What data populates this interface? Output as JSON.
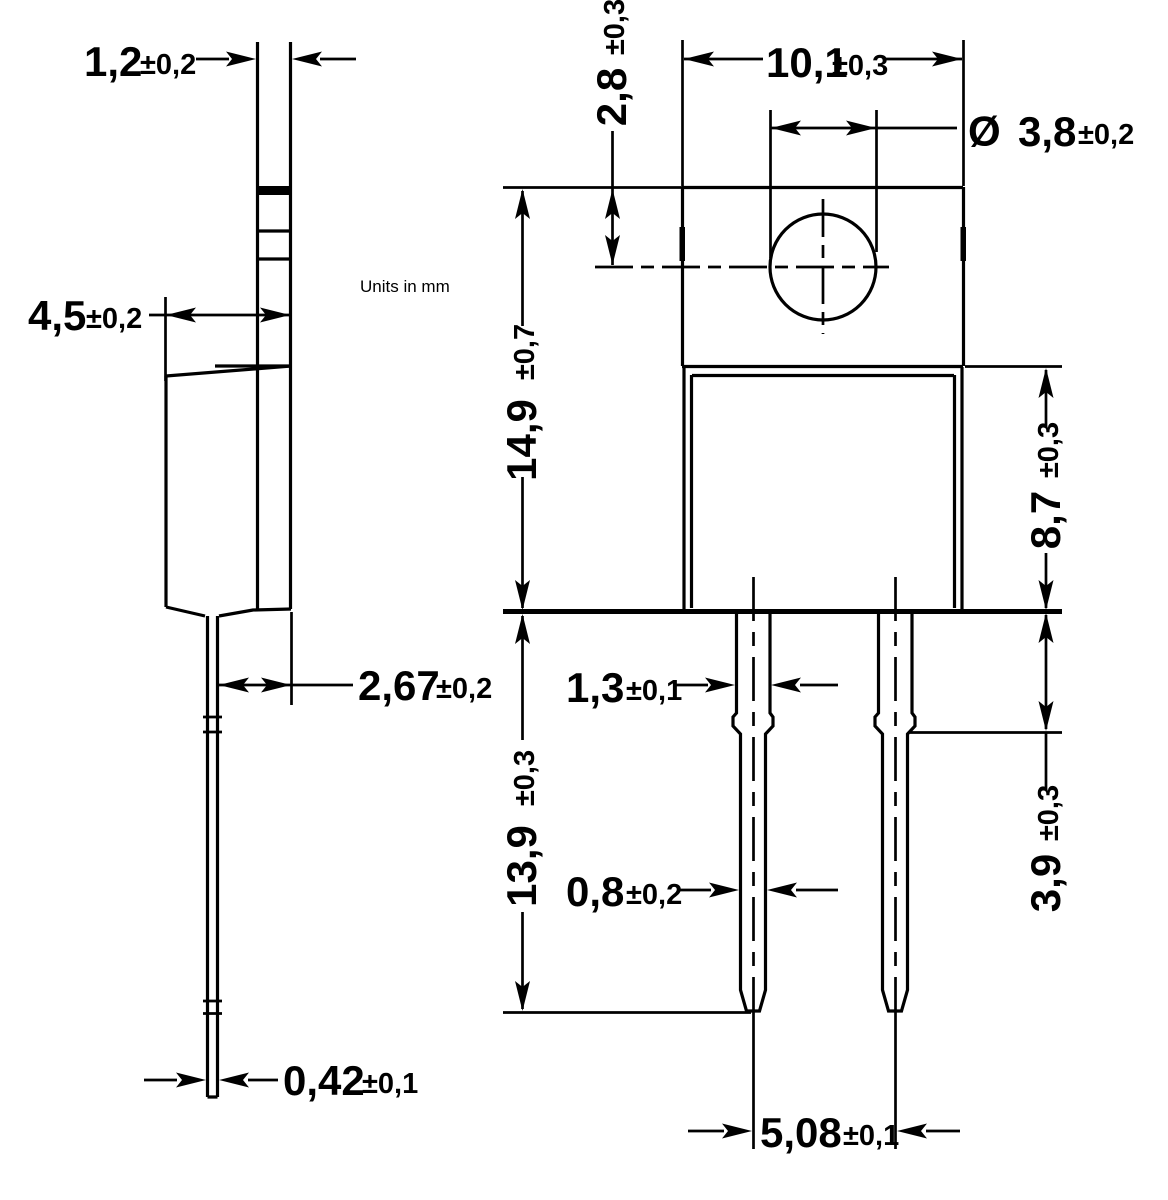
{
  "units_note": "Units in mm",
  "colors": {
    "ink": "#000000",
    "paper": "#ffffff"
  },
  "side_view": {
    "tab_thickness": {
      "value": "1,2",
      "tol": "±0,2"
    },
    "body_depth": {
      "value": "4,5",
      "tol": "±0,2"
    },
    "lead_setback": {
      "value": "2,67",
      "tol": "±0,2"
    },
    "lead_thickness": {
      "value": "0,42",
      "tol": "±0,1"
    }
  },
  "front_view": {
    "body_width": {
      "value": "10,1",
      "tol": "±0,3"
    },
    "hole_diameter": {
      "symbol": "Ø",
      "value": "3,8",
      "tol": "±0,2"
    },
    "hole_center_from_top": {
      "value": "2,8",
      "tol": "±0,3"
    },
    "overall_body_height": {
      "value": "14,9",
      "tol": "±0,7"
    },
    "body_below_tab": {
      "value": "8,7",
      "tol": "±0,3"
    },
    "lead_width_upper": {
      "value": "1,3",
      "tol": "±0,1"
    },
    "lead_length": {
      "value": "13,9",
      "tol": "±0,3"
    },
    "lead_width_lower": {
      "value": "0,8",
      "tol": "±0,2"
    },
    "lead_shoulder_length": {
      "value": "3,9",
      "tol": "±0,3"
    },
    "lead_pitch": {
      "value": "5,08",
      "tol": "±0,1"
    }
  }
}
